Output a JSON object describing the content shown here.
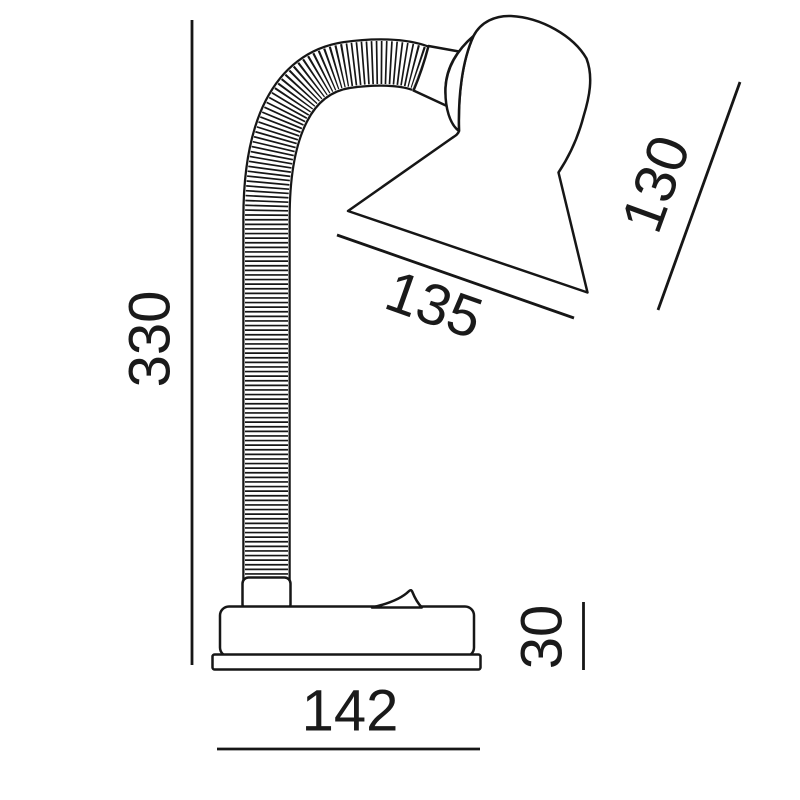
{
  "diagram": {
    "subject": "desk-lamp-dimension-drawing",
    "background_color": "#ffffff",
    "line_color": "#161616",
    "text_color": "#1a1a1a",
    "dimensions": {
      "overall_height": {
        "label": "330"
      },
      "shade_length": {
        "label": "130"
      },
      "shade_opening": {
        "label": "135"
      },
      "base_width": {
        "label": "142"
      },
      "base_height": {
        "label": "30"
      }
    }
  }
}
